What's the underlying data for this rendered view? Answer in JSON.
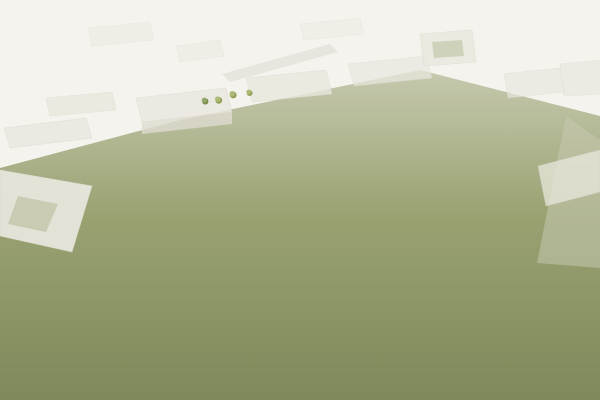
{
  "scene": {
    "type": "aerial-architectural-rendering",
    "subject": "school-campus-birdseye-view",
    "palette": {
      "fog": "#f4f3ee",
      "fogBuilding": "#eae8df",
      "fogBuildingFace": "#dedbd0",
      "groundFar": "#c6c9ae",
      "groundMid": "#99a171",
      "groundNear": "#7e8a5c",
      "grassDark": "#5f6b45",
      "grassSlope": "#a3ab80",
      "treeDark": "#4f6134",
      "treeMid": "#6e7f44",
      "treeLight": "#8e9c55",
      "blossom": "#c293ad",
      "road": "#8e8d88",
      "roadDark": "#7c7b76",
      "roadLine": "#d9d8d2",
      "sidewalk": "#b7b1a3",
      "cream": "#e7e1cf",
      "creamLight": "#f0ece0",
      "creamShadow": "#cfc7b2",
      "roofWhite": "#efece2",
      "roofGray": "#d5d1c4",
      "roofDarkGray": "#857f71",
      "windowDark": "#5b584e",
      "windowWarm": "#6e6557",
      "glassBlue": "#5b93a9",
      "gymGlass": "#7a939b",
      "solarBlue": "#7590bc",
      "solarBlueDark": "#5c77a6",
      "solarGrid": "#c7d2e4",
      "greenRoof": "#7d8f52",
      "pathTan": "#c9a164",
      "plazaTan": "#d8d0bb",
      "terraceTan": "#d9cba6",
      "playgroundTan": "#d2c4a0",
      "wallGray": "#8a8477",
      "wallDark": "#6b665b",
      "courtGreen": "#6f9a55",
      "courtRed": "#b2674d",
      "sculptureRed": "#b2402e",
      "pavilionBlue": "#8fc0d4",
      "grayRoof": "#96978b",
      "grayRoofLight": "#b2afa2",
      "grayRoofDark": "#777a6c",
      "grayBuilding": "#b3b4aa",
      "rightRoof": "#8b8d7f",
      "rightRoofLight": "#a5a79b",
      "carDark": "#35373a",
      "carWhite": "#e4e4e0",
      "carSilver": "#a9a9a5",
      "bird": "#8d8d85",
      "white": "#ffffff"
    },
    "flagColors": [
      "#c0392b",
      "#2960a8",
      "#e8c53a",
      "#2f8a4c",
      "#f5f2ea",
      "#d87f2a",
      "#7a3fa0",
      "#c0392b",
      "#2960a8",
      "#e8c53a",
      "#2f8a4c",
      "#f5f2ea"
    ],
    "legend": {
      "gymnasium": "gymnasium-with-skylights",
      "flyTower": "auditorium-fly-tower",
      "dormitory": "dormitory-slab-building",
      "teaching": "teaching-building-with-flags",
      "courtyardBuilding": "courtyard-building",
      "solarBuilding": "laboratory-building-solar-roof",
      "podium": "podium-with-green-roof-garden",
      "walkway": "covered-walkway",
      "playground": "sports-playground",
      "basketball": "basketball-court",
      "plaza": "circular-entry-plaza",
      "sculpture": "red-sculpture-group",
      "grove": "tree-grove",
      "roads": "city-roads-with-traffic",
      "context": "fog-context-buildings",
      "birds": "flying-birds"
    },
    "counts": {
      "treesApprox": 150,
      "carsApprox": 30,
      "birds": 12,
      "solarPanels": 5
    }
  }
}
